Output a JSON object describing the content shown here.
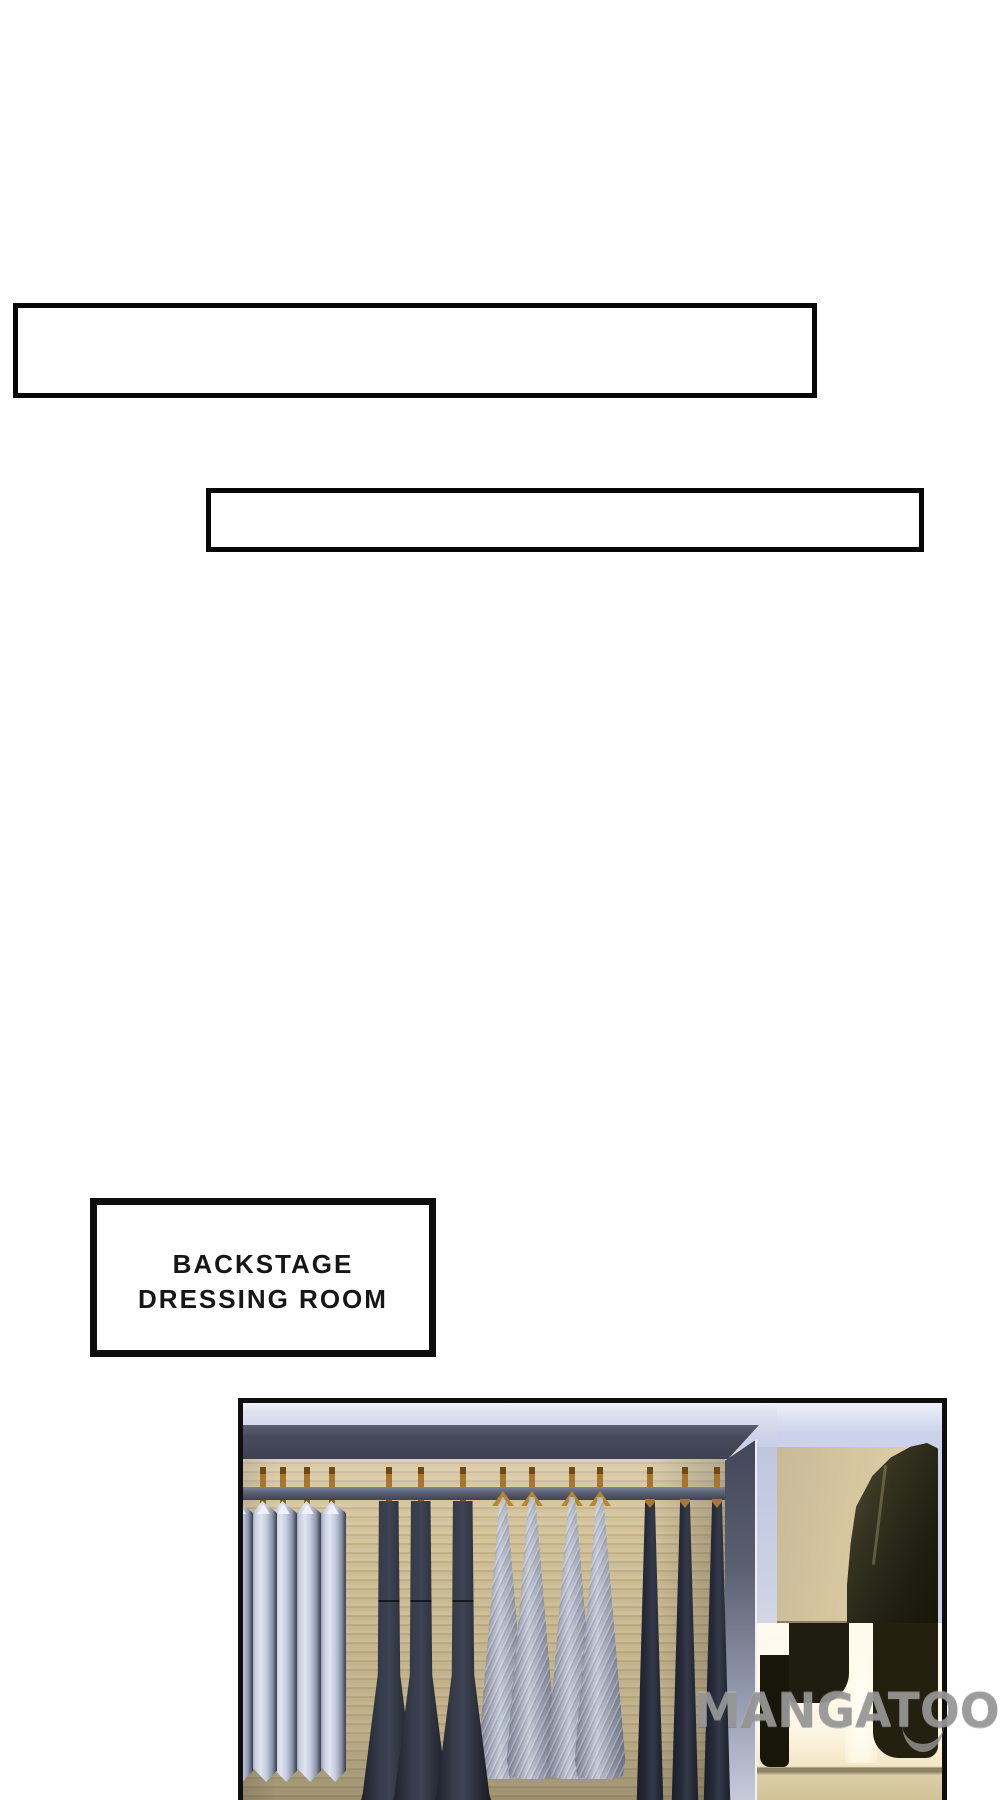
{
  "page": {
    "kind": "comic-page",
    "background": "#ffffff"
  },
  "speech_boxes": [
    {
      "text": ""
    },
    {
      "text": ""
    }
  ],
  "sign": {
    "line1": "BACKSTAGE",
    "line2": "DRESSING ROOM"
  },
  "watermark": {
    "text": "MANGATOON"
  },
  "palette": {
    "ink": "#0d0d0d",
    "ceiling": "#c8cde3",
    "beam": "#464a5a",
    "wood_wall": "#cdbd95",
    "rail": "#5b6072",
    "hanger_wood": "#a9742c",
    "hanger_gold": "#b8862e",
    "shirt_light": "#c7cedf",
    "navy_gown": "#343947",
    "sequin_dress": "#9ba0b1",
    "dark_gown": "#1c1f2a",
    "side_wall": "#ccd1e4",
    "lamp_wall": "#e8d7ac",
    "lamp_glow": "#fffef7",
    "shadow_shape": "#1f1d10",
    "floor": "#dbcda6",
    "watermark_gray": "#969696"
  }
}
